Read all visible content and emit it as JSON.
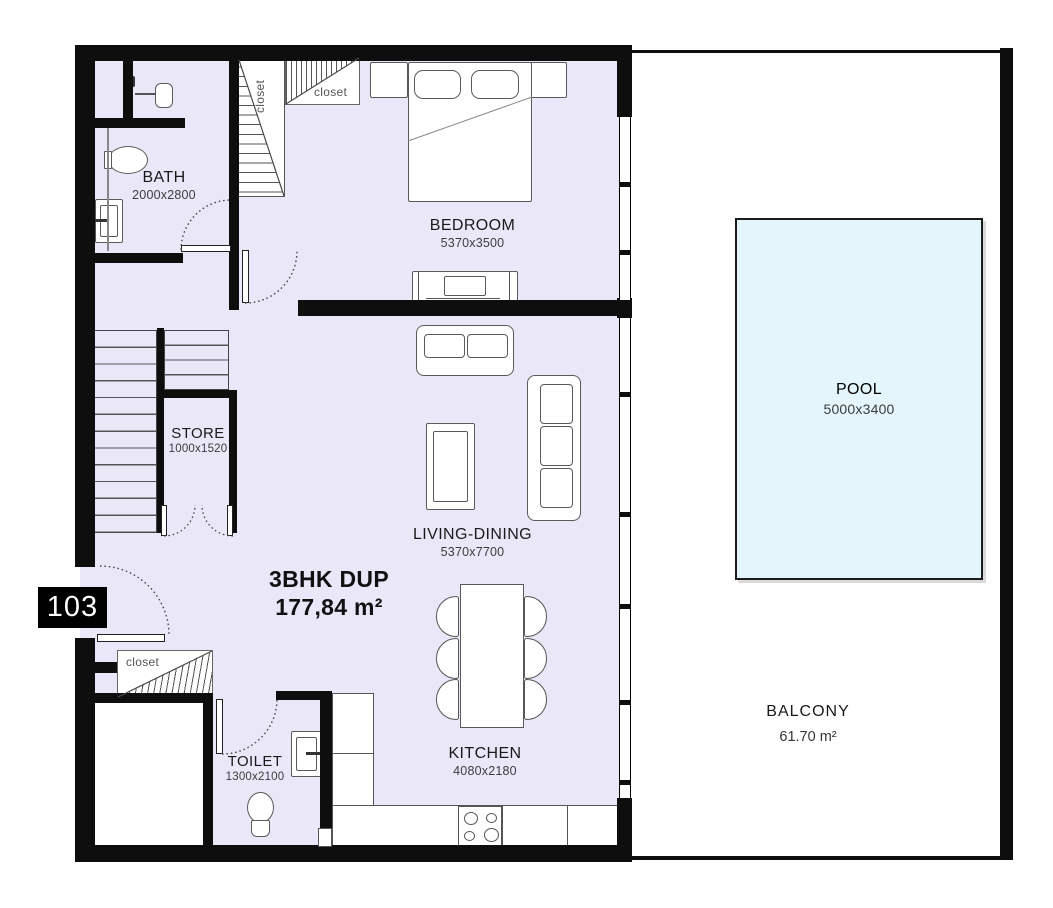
{
  "unit": {
    "number": "103",
    "type_line": "3BHK DUP",
    "area_line": "177,84  m²"
  },
  "rooms": {
    "bath": {
      "name": "BATH",
      "dims": "2000x2800"
    },
    "bedroom": {
      "name": "BEDROOM",
      "dims": "5370x3500"
    },
    "store": {
      "name": "STORE",
      "dims": "1000x1520"
    },
    "living": {
      "name": "LIVING-DINING",
      "dims": "5370x7700"
    },
    "kitchen": {
      "name": "KITCHEN",
      "dims": "4080x2180"
    },
    "toilet": {
      "name": "TOILET",
      "dims": "1300x2100"
    },
    "pool": {
      "name": "POOL",
      "dims": "5000x3400"
    },
    "balcony": {
      "name": "BALCONY",
      "area": "61.70 m²"
    }
  },
  "labels": {
    "closet_stair": "closet",
    "closet_top": "closet",
    "closet_entry": "closet"
  },
  "colors": {
    "wall": "#0e0e0e",
    "floor_fill": "#eae8f8",
    "pool_fill": "#e4f6fc",
    "pool_border": "#1b1b1b",
    "room_text": "#1a1a1a",
    "dim_text": "#3c3c3c",
    "furniture_outline": "#555555",
    "badge_bg": "#000000",
    "badge_text": "#ffffff"
  }
}
